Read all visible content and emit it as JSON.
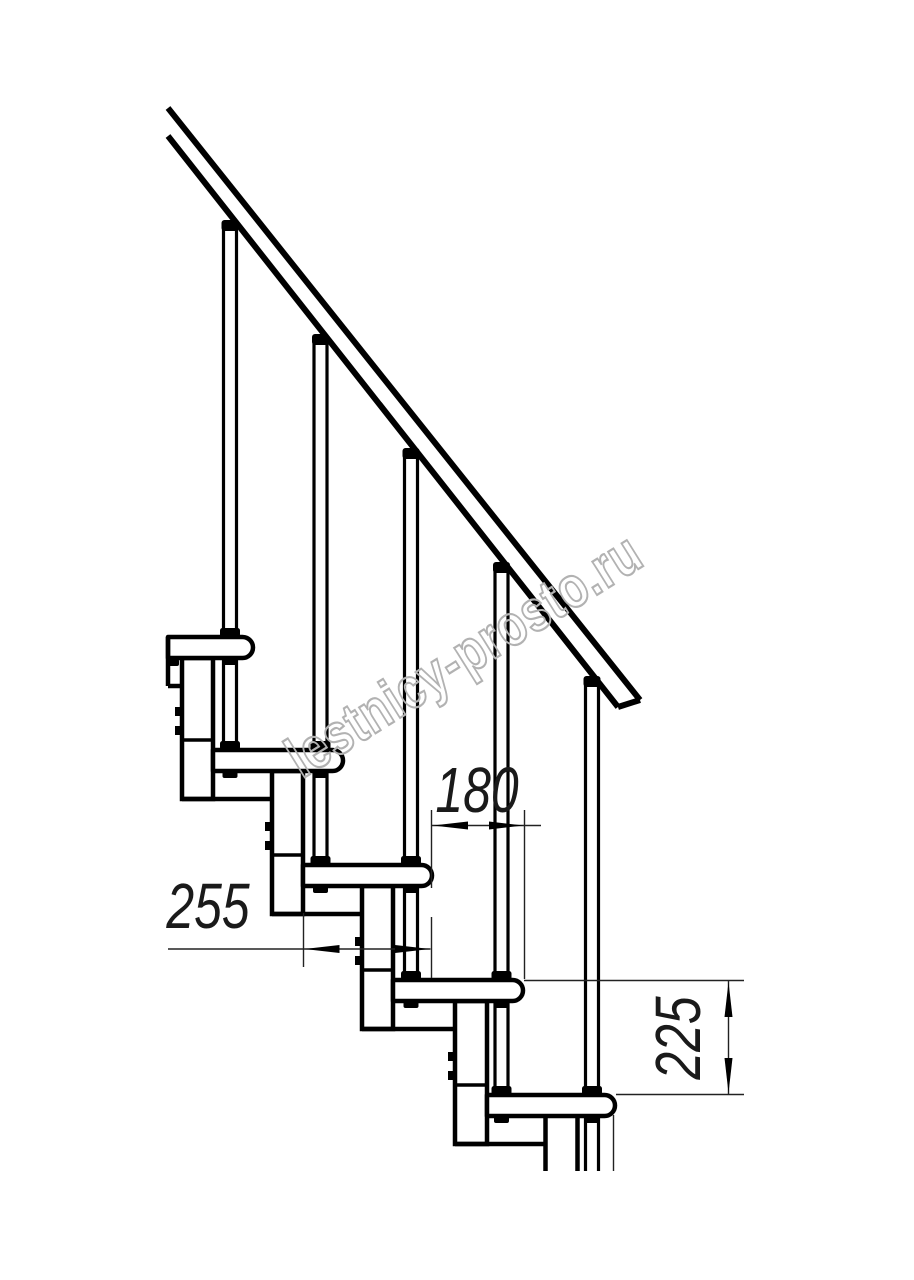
{
  "document": {
    "kind": "technical-drawing",
    "subject": "modular staircase side elevation",
    "background_color": "#ffffff",
    "line_color": "#000000"
  },
  "watermark": {
    "text": "lestnicy-prosto.ru",
    "color": "#b2b2b2"
  },
  "dimensions": {
    "tread_depth": {
      "label": "255"
    },
    "tread_run": {
      "label": "180"
    },
    "riser_height": {
      "label": "225"
    }
  },
  "structure": {
    "treads_visible": 5,
    "balusters_visible": 5,
    "support_columns_visible": 5
  }
}
